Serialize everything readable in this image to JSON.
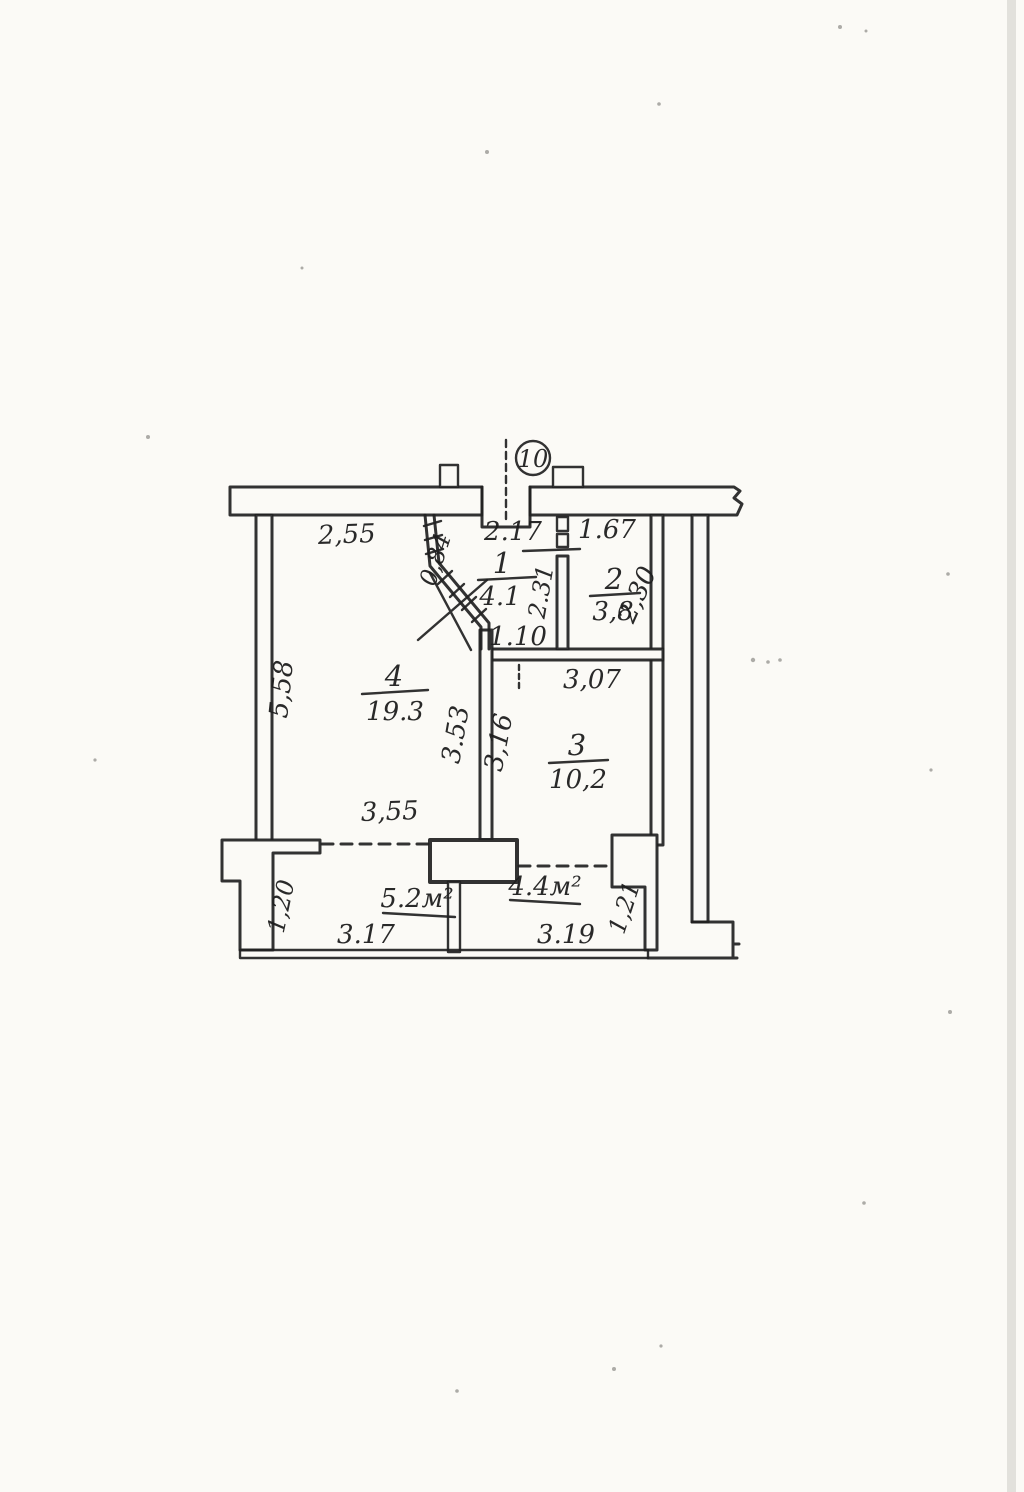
{
  "page": {
    "kind": "scanned BTI apartment floor plan",
    "paper_color": "#fbfaf6",
    "ink_color": "#212121"
  },
  "plan": {
    "apartment_number": "10",
    "rooms": [
      {
        "number": "1",
        "area": "4.1"
      },
      {
        "number": "2",
        "area": "3,8"
      },
      {
        "number": "3",
        "area": "10,2"
      },
      {
        "number": "4",
        "area": "19.3"
      }
    ],
    "balconies": [
      {
        "area": "5.2м²"
      },
      {
        "area": "4.4м²"
      }
    ],
    "dimensions": {
      "room4_top_width": "2,55",
      "entry_width": "2.17",
      "room2_top_width": "1.67",
      "hall_diagonal_offset": "0,84",
      "hall_room2_wall_depth": "2.31",
      "room2_right_height": "2,30",
      "hall_bottom_width": "1.10",
      "room3_top_width": "3,07",
      "room4_left_height": "5,58",
      "room4_right_height": "3.53",
      "room3_left_height": "3,16",
      "room4_bottom_width": "3,55",
      "balcony_left_depth": "1,20",
      "balcony_left_width": "3.17",
      "balcony_right_width": "3.19",
      "balcony_right_depth": "1,21"
    }
  }
}
